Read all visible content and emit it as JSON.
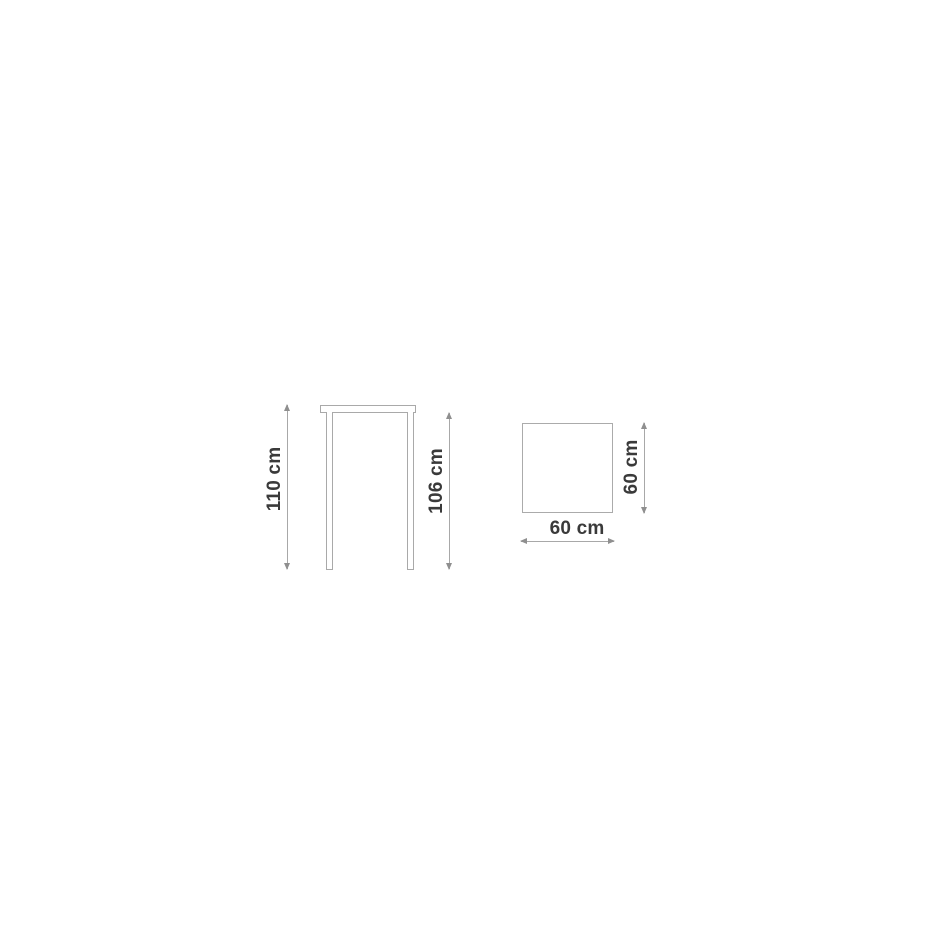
{
  "diagram": {
    "type": "furniture-dimension-drawing",
    "front_view": {
      "left_dimension": "110 cm",
      "right_dimension": "106 cm"
    },
    "top_view": {
      "bottom_dimension": "60 cm",
      "right_dimension": "60 cm"
    },
    "colors": {
      "outline": "#a9a9a9",
      "dimension_line": "#a8a8a8",
      "arrow": "#8f8f8f",
      "text": "#3a3a3a",
      "background": "#ffffff"
    }
  }
}
